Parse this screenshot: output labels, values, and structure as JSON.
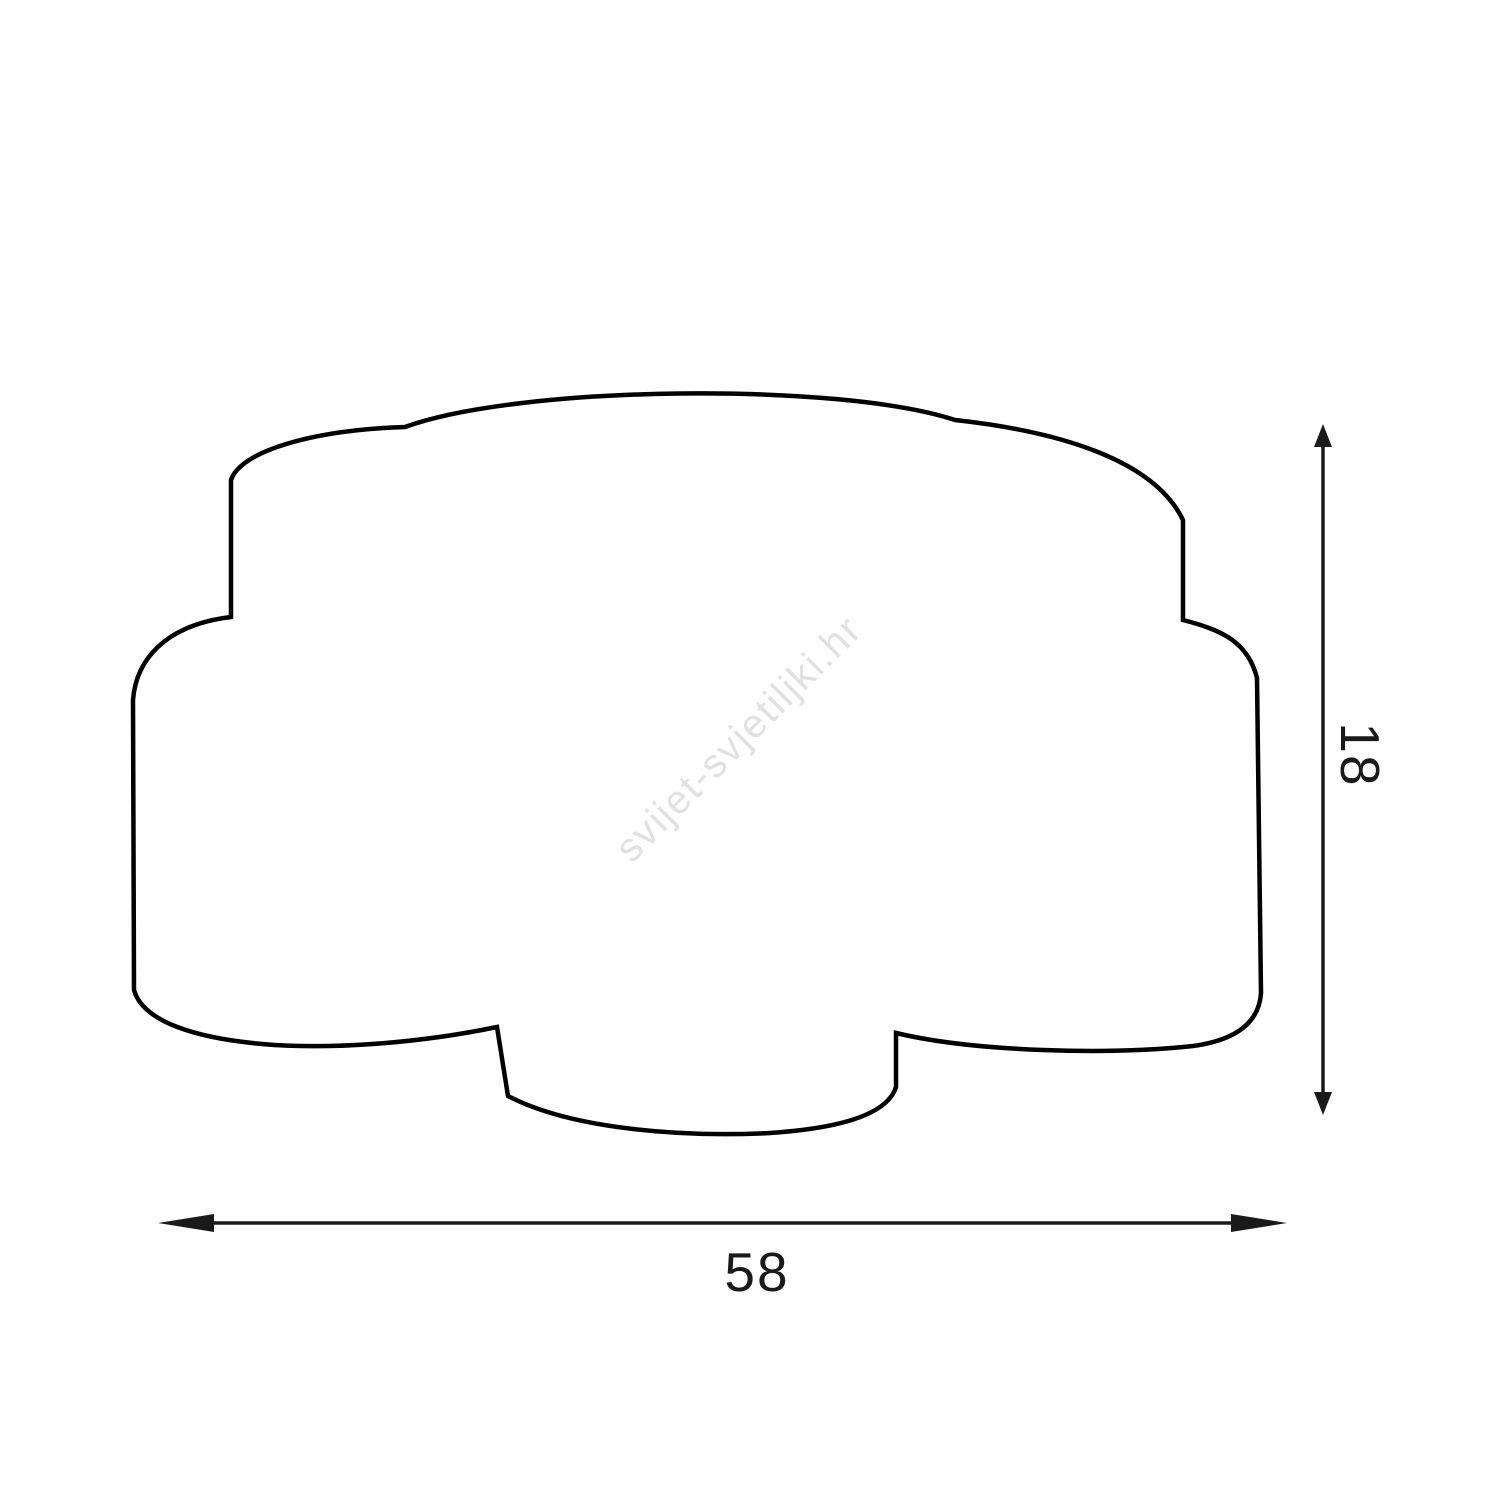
{
  "diagram": {
    "kind": "product-dimension-drawing",
    "subject": "ceiling-lamp-silhouette",
    "width_label": "58",
    "height_label": "18",
    "watermark": "svijet-svjetiljki.hr",
    "outline_color": "#000000",
    "dimension_color": "#1a1a1a",
    "watermark_color": "#e1e1e1",
    "background_color": "#ffffff"
  }
}
